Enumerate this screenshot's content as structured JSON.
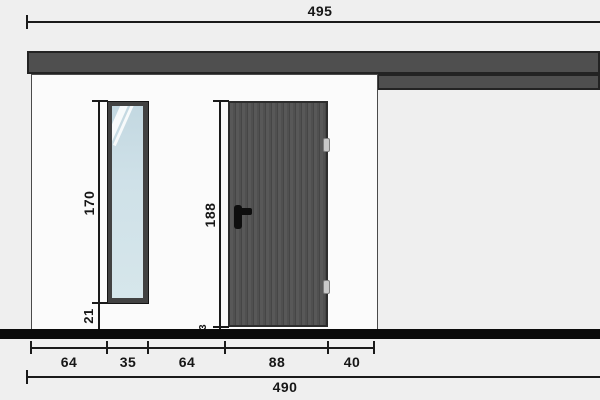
{
  "dims": {
    "roof_width": {
      "label": "495"
    },
    "total_width": {
      "label": "490"
    },
    "segments": [
      "64",
      "35",
      "64",
      "88",
      "40"
    ],
    "window_height": "170",
    "sill_height": "21",
    "door_height": "188",
    "threshold_height": "3"
  },
  "colors": {
    "background": "#efefef",
    "wall": "#fbfbfb",
    "roof_fascia": "#4f4f4f",
    "door": "#535353",
    "window_glass": "#cfe1e8",
    "ground": "#0b0b0b",
    "dimension_ink": "#161616"
  }
}
